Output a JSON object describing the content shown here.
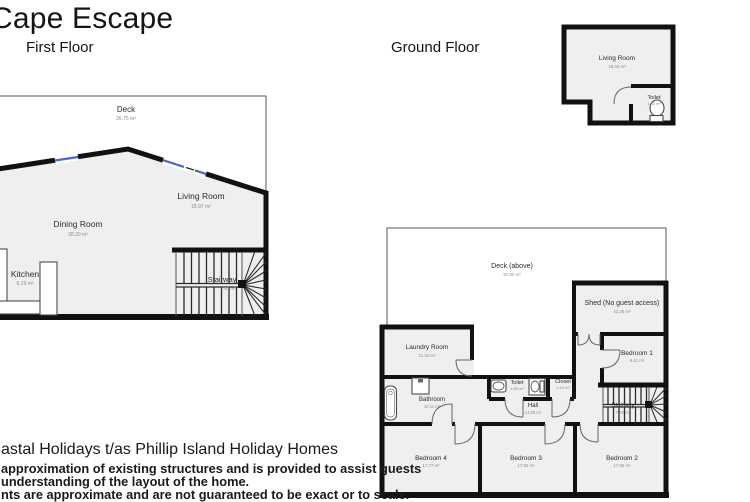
{
  "title": "Cape Escape",
  "first_floor": {
    "header": "First Floor",
    "rooms": {
      "deck": {
        "name": "Deck",
        "area": "26.75 m²"
      },
      "living_room": {
        "name": "Living Room",
        "area": "18.97 m²"
      },
      "dining_room": {
        "name": "Dining Room",
        "area": "28.20 m²"
      },
      "kitchen": {
        "name": "Kitchen",
        "area": "6.19 m²"
      },
      "stairway": {
        "name": "Stairway",
        "area": "4.50 m²"
      }
    }
  },
  "ground_floor": {
    "header": "Ground Floor",
    "annex": {
      "living_room": {
        "name": "Living Room",
        "area": "18.46 m²"
      },
      "toilet": {
        "name": "Toilet",
        "area": "1.80 m²"
      }
    },
    "rooms": {
      "deck_above": {
        "name": "Deck (above)",
        "area": "97.92 m²"
      },
      "shed": {
        "name": "Shed (No guest access)",
        "area": "42.26 m²"
      },
      "laundry_room": {
        "name": "Laundry Room",
        "area": "11.34 m²"
      },
      "bedroom_1": {
        "name": "Bedroom 1",
        "area": "9.41 m²"
      },
      "bathroom": {
        "name": "Bathroom",
        "area": "10.11 m²"
      },
      "toilet": {
        "name": "Toilet",
        "area": "1.89 m²"
      },
      "closet": {
        "name": "Closet",
        "area": "1.44 m²"
      },
      "hall": {
        "name": "Hall",
        "area": "14.00 m²"
      },
      "stairway": {
        "name": "Stairway",
        "area": "7.20 m²"
      },
      "bedroom_4": {
        "name": "Bedroom 4",
        "area": "17.77 m²"
      },
      "bedroom_3": {
        "name": "Bedroom 3",
        "area": "17.92 m²"
      },
      "bedroom_2": {
        "name": "Bedroom 2",
        "area": "17.96 m²"
      }
    }
  },
  "footer": {
    "line1": "astal Holidays t/as Phillip Island Holiday Homes",
    "line2": "approximation of existing structures and is provided to assist guests",
    "line3": "understanding of the layout of the home.",
    "line4": "nts are approximate and are not guaranteed to be exact or to scale."
  },
  "colors": {
    "wall": "#111111",
    "room_fill": "#efefef",
    "window": "#4a68cc",
    "label": "#2b2b2b",
    "area_label": "#8a8a8a"
  }
}
